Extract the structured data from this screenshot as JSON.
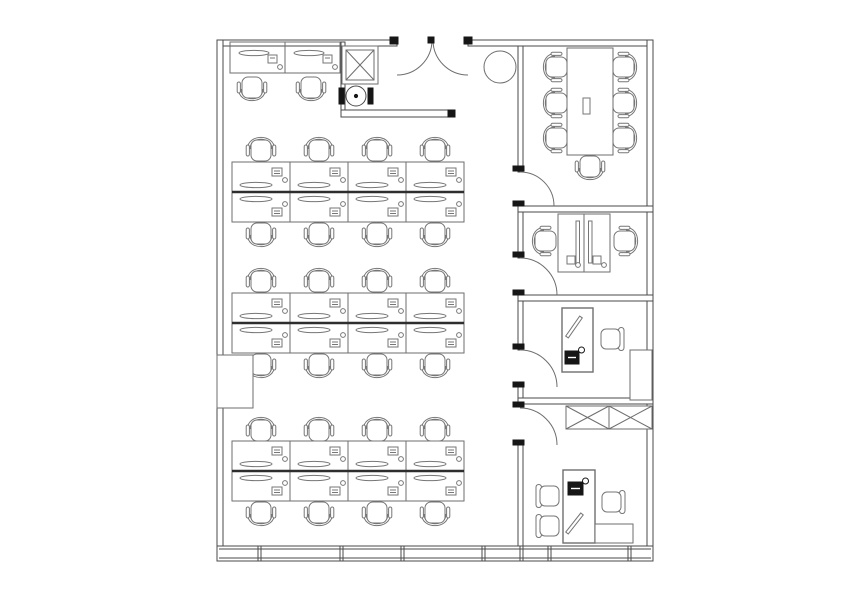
{
  "floor_plan": {
    "canvas": {
      "width": 846,
      "height": 600
    },
    "style": {
      "background": "#ffffff",
      "wall_color": "#4a4a4a",
      "line_color": "#6e6e6e",
      "furniture_color": "#767676",
      "thick_divider_color": "#2e2e2e",
      "dark_color": "#161616"
    },
    "walls": [
      {
        "name": "top-wall-left",
        "x": 217,
        "y": 40,
        "w": 180,
        "h": 6
      },
      {
        "name": "top-wall-right",
        "x": 468,
        "y": 40,
        "w": 185,
        "h": 6
      },
      {
        "name": "left-wall",
        "x": 217,
        "y": 40,
        "w": 6,
        "h": 506
      },
      {
        "name": "right-wall",
        "x": 647,
        "y": 40,
        "w": 6,
        "h": 506
      },
      {
        "name": "meeting-room-west-wall",
        "x": 518,
        "y": 46,
        "w": 5,
        "h": 126
      },
      {
        "name": "corridor-wall-seg-1",
        "x": 518,
        "y": 212,
        "w": 5,
        "h": 46
      },
      {
        "name": "corridor-wall-seg-2",
        "x": 518,
        "y": 295,
        "w": 5,
        "h": 55
      },
      {
        "name": "corridor-wall-seg-3",
        "x": 518,
        "y": 387,
        "w": 5,
        "h": 11
      },
      {
        "name": "corridor-wall-seg-4",
        "x": 518,
        "y": 445,
        "w": 5,
        "h": 101
      },
      {
        "name": "meeting-room-south-wall",
        "x": 518,
        "y": 206,
        "w": 135,
        "h": 6
      },
      {
        "name": "office-2p-south-wall",
        "x": 518,
        "y": 295,
        "w": 135,
        "h": 6
      },
      {
        "name": "office-3-south-wall",
        "x": 518,
        "y": 398,
        "w": 135,
        "h": 6
      }
    ],
    "partitions": [
      {
        "name": "entry-closet-wall-vertical",
        "x": 341,
        "y": 42,
        "w": 4,
        "h": 75
      },
      {
        "name": "entry-closet-wall-horizontal",
        "x": 341,
        "y": 110,
        "w": 114,
        "h": 7
      }
    ],
    "doors": [
      {
        "name": "entrance-door-left",
        "d": "M432,40 A35,35 0 0 1 397,75"
      },
      {
        "name": "entrance-door-right",
        "d": "M433,40 A35,35 0 0 0 468,75"
      },
      {
        "name": "meeting-room-door",
        "d": "M520,172 A34,34 0 0 1 554,206"
      },
      {
        "name": "office-2p-door",
        "d": "M520,258 A37,37 0 0 1 557,295"
      },
      {
        "name": "office-3-door",
        "d": "M520,350 A37,37 0 0 1 557,387"
      },
      {
        "name": "office-exec-door",
        "d": "M520,408 A37,37 0 0 1 557,445"
      }
    ],
    "jamb_marks": [
      {
        "x": 390,
        "y": 37,
        "w": 8,
        "h": 7
      },
      {
        "x": 464,
        "y": 37,
        "w": 8,
        "h": 7
      },
      {
        "x": 428,
        "y": 37,
        "w": 6,
        "h": 6
      },
      {
        "x": 448,
        "y": 110,
        "w": 7,
        "h": 7
      },
      {
        "x": 513,
        "y": 166,
        "w": 11,
        "h": 5
      },
      {
        "x": 513,
        "y": 201,
        "w": 11,
        "h": 5
      },
      {
        "x": 513,
        "y": 252,
        "w": 11,
        "h": 5
      },
      {
        "x": 513,
        "y": 290,
        "w": 11,
        "h": 5
      },
      {
        "x": 513,
        "y": 344,
        "w": 11,
        "h": 5
      },
      {
        "x": 513,
        "y": 382,
        "w": 11,
        "h": 5
      },
      {
        "x": 513,
        "y": 402,
        "w": 11,
        "h": 5
      },
      {
        "x": 513,
        "y": 440,
        "w": 11,
        "h": 5
      }
    ],
    "window_band": {
      "x": 217,
      "y": 546,
      "w": 436,
      "h": 15,
      "inset": 3,
      "mullions": [
        258,
        340,
        401,
        482,
        520,
        548,
        628
      ]
    },
    "desk_banks": [
      {
        "name": "desk-bank-1",
        "x": 232,
        "y": 162,
        "cols": 4,
        "col_w": 58,
        "row_h": 30
      },
      {
        "name": "desk-bank-2",
        "x": 232,
        "y": 293,
        "cols": 4,
        "col_w": 58,
        "row_h": 30
      },
      {
        "name": "desk-bank-3",
        "x": 232,
        "y": 441,
        "cols": 4,
        "col_w": 58,
        "row_h": 30
      }
    ],
    "wall_desks": {
      "name": "wall-desk-pair",
      "x": 230,
      "y": 42,
      "w": 110,
      "h": 31,
      "divider_x": 285
    },
    "chairs": [
      {
        "x": 252,
        "y": 91,
        "rot": 180,
        "type": "task"
      },
      {
        "x": 311,
        "y": 91,
        "rot": 180,
        "type": "task"
      },
      {
        "x": 261,
        "y": 147,
        "rot": 0,
        "type": "task"
      },
      {
        "x": 319,
        "y": 147,
        "rot": 0,
        "type": "task"
      },
      {
        "x": 377,
        "y": 147,
        "rot": 0,
        "type": "task"
      },
      {
        "x": 435,
        "y": 147,
        "rot": 0,
        "type": "task"
      },
      {
        "x": 261,
        "y": 237,
        "rot": 180,
        "type": "task"
      },
      {
        "x": 319,
        "y": 237,
        "rot": 180,
        "type": "task"
      },
      {
        "x": 377,
        "y": 237,
        "rot": 180,
        "type": "task"
      },
      {
        "x": 435,
        "y": 237,
        "rot": 180,
        "type": "task"
      },
      {
        "x": 261,
        "y": 278,
        "rot": 0,
        "type": "task"
      },
      {
        "x": 319,
        "y": 278,
        "rot": 0,
        "type": "task"
      },
      {
        "x": 377,
        "y": 278,
        "rot": 0,
        "type": "task"
      },
      {
        "x": 435,
        "y": 278,
        "rot": 0,
        "type": "task"
      },
      {
        "x": 261,
        "y": 368,
        "rot": 180,
        "type": "task"
      },
      {
        "x": 319,
        "y": 368,
        "rot": 180,
        "type": "task"
      },
      {
        "x": 377,
        "y": 368,
        "rot": 180,
        "type": "task"
      },
      {
        "x": 435,
        "y": 368,
        "rot": 180,
        "type": "task"
      },
      {
        "x": 261,
        "y": 427,
        "rot": 0,
        "type": "task"
      },
      {
        "x": 319,
        "y": 427,
        "rot": 0,
        "type": "task"
      },
      {
        "x": 377,
        "y": 427,
        "rot": 0,
        "type": "task"
      },
      {
        "x": 435,
        "y": 427,
        "rot": 0,
        "type": "task"
      },
      {
        "x": 261,
        "y": 516,
        "rot": 180,
        "type": "task"
      },
      {
        "x": 319,
        "y": 516,
        "rot": 180,
        "type": "task"
      },
      {
        "x": 377,
        "y": 516,
        "rot": 180,
        "type": "task"
      },
      {
        "x": 435,
        "y": 516,
        "rot": 180,
        "type": "task"
      },
      {
        "x": 553,
        "y": 67,
        "rot": 270,
        "type": "task"
      },
      {
        "x": 553,
        "y": 103,
        "rot": 270,
        "type": "task"
      },
      {
        "x": 553,
        "y": 138,
        "rot": 270,
        "type": "task"
      },
      {
        "x": 627,
        "y": 67,
        "rot": 90,
        "type": "task"
      },
      {
        "x": 627,
        "y": 103,
        "rot": 90,
        "type": "task"
      },
      {
        "x": 627,
        "y": 138,
        "rot": 90,
        "type": "task"
      },
      {
        "x": 590,
        "y": 170,
        "rot": 180,
        "type": "task"
      },
      {
        "x": 542,
        "y": 241,
        "rot": 270,
        "type": "task"
      },
      {
        "x": 628,
        "y": 241,
        "rot": 90,
        "type": "task"
      },
      {
        "x": 612,
        "y": 339,
        "rot": 90,
        "type": "guest"
      },
      {
        "x": 548,
        "y": 496,
        "rot": 270,
        "type": "guest"
      },
      {
        "x": 548,
        "y": 526,
        "rot": 270,
        "type": "guest"
      },
      {
        "x": 613,
        "y": 502,
        "rot": 90,
        "type": "guest"
      }
    ],
    "meeting_room": {
      "table": {
        "x": 567,
        "y": 48,
        "w": 46,
        "h": 107
      },
      "table_item": {
        "x": 583,
        "y": 98,
        "w": 7,
        "h": 16
      }
    },
    "office_2p": {
      "desk_block": {
        "x": 558,
        "y": 214,
        "w": 52,
        "h": 58,
        "split_x": 584
      },
      "monitors": [
        {
          "x": 576,
          "y": 221,
          "w": 3.5,
          "h": 42
        },
        {
          "x": 588.5,
          "y": 221,
          "w": 3.5,
          "h": 42
        }
      ],
      "pcs": [
        {
          "x": 567,
          "y": 256,
          "w": 8,
          "h": 8
        },
        {
          "x": 593,
          "y": 256,
          "w": 8,
          "h": 8
        }
      ]
    },
    "office_3": {
      "desk": {
        "x": 562,
        "y": 308,
        "w": 31,
        "h": 64
      },
      "pen": {
        "x1": 567,
        "y1": 337,
        "x2": 581,
        "y2": 317
      },
      "phone": {
        "x": 565,
        "y": 351,
        "w": 14,
        "h": 13
      },
      "cabinet": {
        "x": 630,
        "y": 350,
        "w": 22,
        "h": 50
      }
    },
    "office_exec": {
      "desk": {
        "x": 563,
        "y": 470,
        "w": 32,
        "h": 73
      },
      "phone": {
        "x": 568,
        "y": 482,
        "w": 15,
        "h": 13
      },
      "pen": {
        "x1": 567,
        "y1": 533,
        "x2": 582,
        "y2": 514
      },
      "return_cabinet": {
        "x": 595,
        "y": 524,
        "w": 38,
        "h": 19
      }
    },
    "storage_cabinets": {
      "x": 566,
      "y": 406,
      "w": 86,
      "h": 23,
      "cells": 2
    },
    "entry": {
      "x_cabinet": {
        "x": 342,
        "y": 46,
        "w": 36,
        "h": 38,
        "inset": 4
      },
      "water_dispenser": {
        "cx": 356,
        "cy": 96,
        "r": 10,
        "side_w": 5,
        "side_h": 16
      },
      "plant": {
        "cx": 500,
        "cy": 67,
        "r": 16
      }
    },
    "pantry_counter": {
      "x": 217,
      "y": 355,
      "w": 36,
      "h": 53
    }
  }
}
